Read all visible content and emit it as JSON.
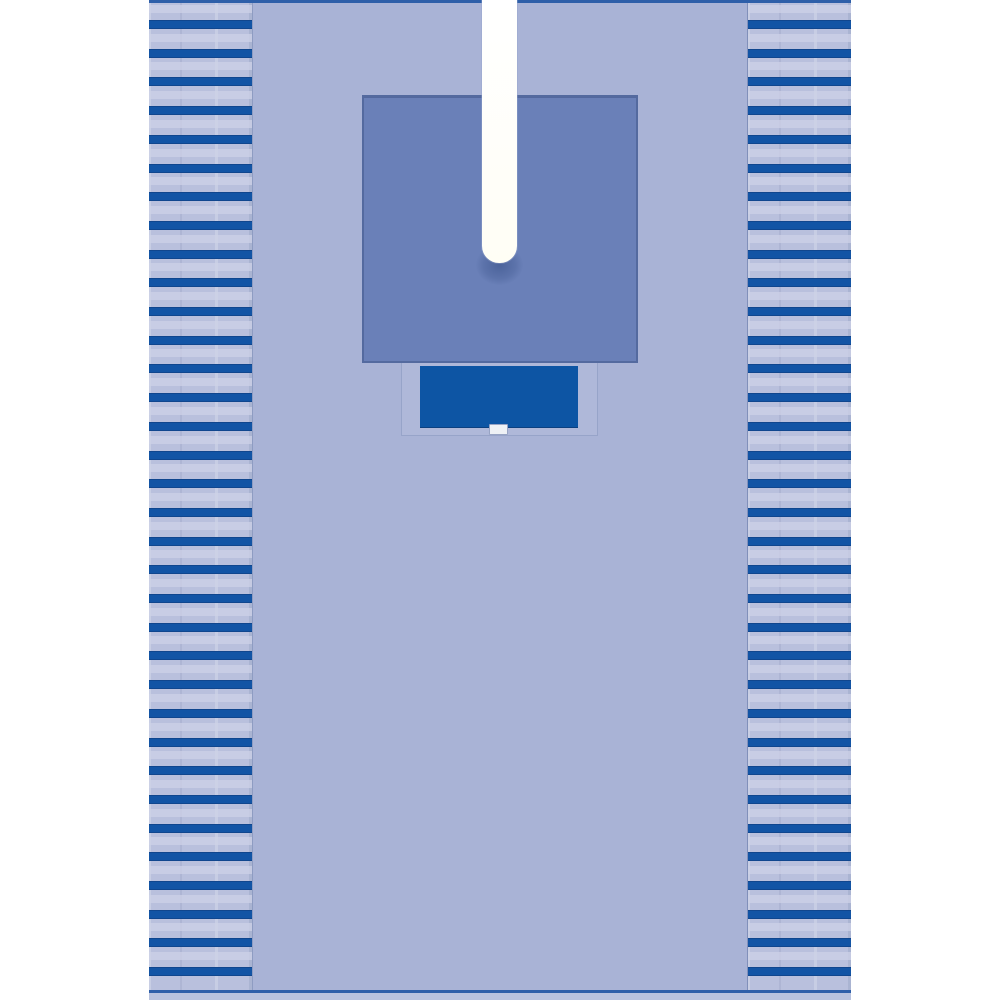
{
  "scene": {
    "subject": "surgical-split-drape-product-photo",
    "background_color": "#ffffff"
  },
  "drape": {
    "body_color": "#a9b3d6",
    "edge_color": "#2e5fa9",
    "hem_color": "#b8c2de",
    "fringe": {
      "background_color": "#b9c0dd",
      "highlight_color": "#cdd2e7",
      "stripe_color": "#1254a5",
      "stripe_count_per_side": 34,
      "sides": [
        "left",
        "right"
      ]
    },
    "reinforcement_pad": {
      "fill_color": "#6a80b8",
      "border_color": "#546a9f"
    },
    "fenestration_split": {
      "fill_color": "#fffef5",
      "end_shadow_color": "#324b82",
      "shape": "vertical-slot-rounded-end"
    },
    "pouch": {
      "fill_color": "#0d55a4"
    },
    "pouch_tab": {
      "fill_color": "#eef1f5",
      "border_color": "#98a4c4"
    }
  }
}
